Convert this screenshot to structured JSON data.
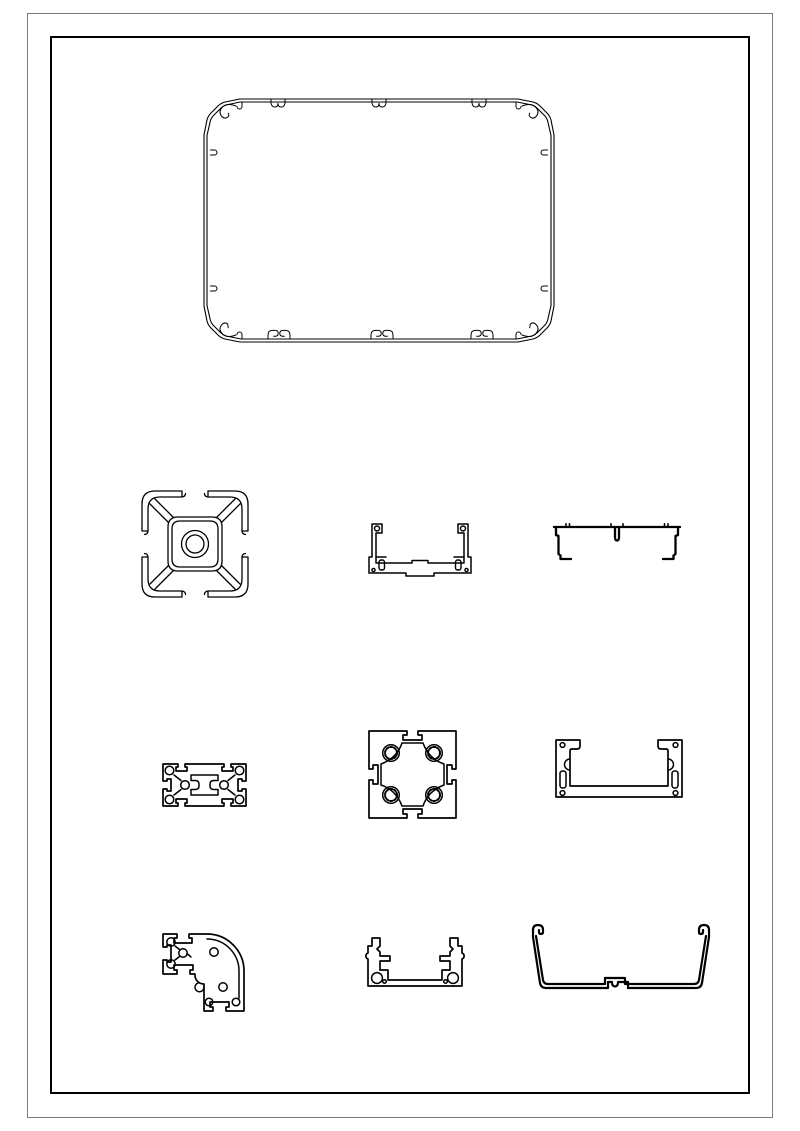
{
  "page": {
    "background": "#ffffff",
    "outer_border_color": "#7a7a7a",
    "inner_border_color": "#000000",
    "line_color": "#000000",
    "outer_frame": {
      "left": 27,
      "top": 13,
      "width": 746,
      "height": 1105
    },
    "inner_frame": {
      "left": 50,
      "top": 36,
      "width": 700,
      "height": 1058
    }
  },
  "drawing": {
    "description": "Technical drawing sheet with cross-sections of aluminium extrusion profiles",
    "profile_count": 10
  },
  "profiles": [
    {
      "name": "enclosure-shell-profile",
      "desc": "large rounded rectangular enclosure extrusion with corner screw bosses",
      "left": 202,
      "top": 97,
      "width": 354,
      "height": 247
    },
    {
      "name": "square-single-bore-profile",
      "desc": "square T-slot extrusion with central round bore",
      "left": 140,
      "top": 489,
      "width": 110,
      "height": 110
    },
    {
      "name": "u-channel-a-profile",
      "desc": "U-channel extrusion with side holes and slotted feet",
      "left": 366,
      "top": 521,
      "width": 108,
      "height": 58
    },
    {
      "name": "cover-channel-profile",
      "desc": "thin cover channel with centre rib and hooked feet",
      "left": 551,
      "top": 521,
      "width": 132,
      "height": 45
    },
    {
      "name": "rect-two-slot-profile",
      "desc": "rectangular T-slot extrusion with six screw bores",
      "left": 161,
      "top": 762,
      "width": 87,
      "height": 46
    },
    {
      "name": "square-four-bore-profile",
      "desc": "square T-slot extrusion with four serrated screw bores",
      "left": 367,
      "top": 729,
      "width": 91,
      "height": 90
    },
    {
      "name": "c-channel-profile",
      "desc": "C-channel housing extrusion with wall slots and screw bores",
      "left": 554,
      "top": 738,
      "width": 130,
      "height": 61
    },
    {
      "name": "radius-corner-profile",
      "desc": "quarter-round corner T-slot extrusion",
      "left": 161,
      "top": 932,
      "width": 85,
      "height": 81
    },
    {
      "name": "u-channel-b-profile",
      "desc": "U-channel extrusion with bottom bores and hooked tops",
      "left": 364,
      "top": 936,
      "width": 102,
      "height": 52
    },
    {
      "name": "tray-profile",
      "desc": "wide open tray extrusion with hooked rims and centre boss",
      "left": 524,
      "top": 922,
      "width": 194,
      "height": 78
    }
  ]
}
